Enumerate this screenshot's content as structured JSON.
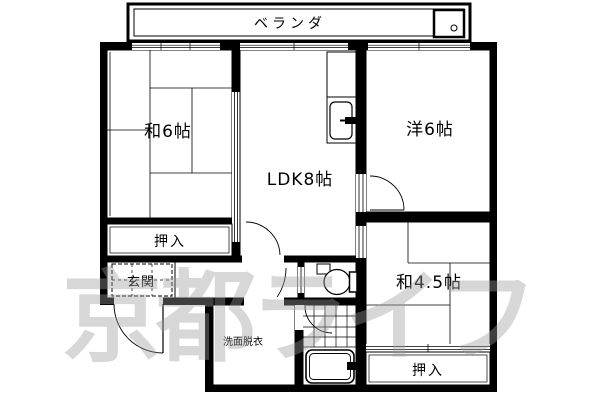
{
  "floorplan": {
    "veranda_label": "ベランダ",
    "rooms": {
      "washitsu6": "和6帖",
      "ldk": "LDK8帖",
      "yoshitsu6": "洋6帖",
      "washitsu45": "和4.5帖",
      "oshiire_upper": "押入",
      "oshiire_lower": "押入",
      "genkan": "玄関",
      "senmen_datsui": "洗面脱衣"
    },
    "watermark": "京都ライフ",
    "colors": {
      "wall": "#000000",
      "floor": "#ffffff",
      "watermark_gray": "#9a9a9a"
    }
  }
}
